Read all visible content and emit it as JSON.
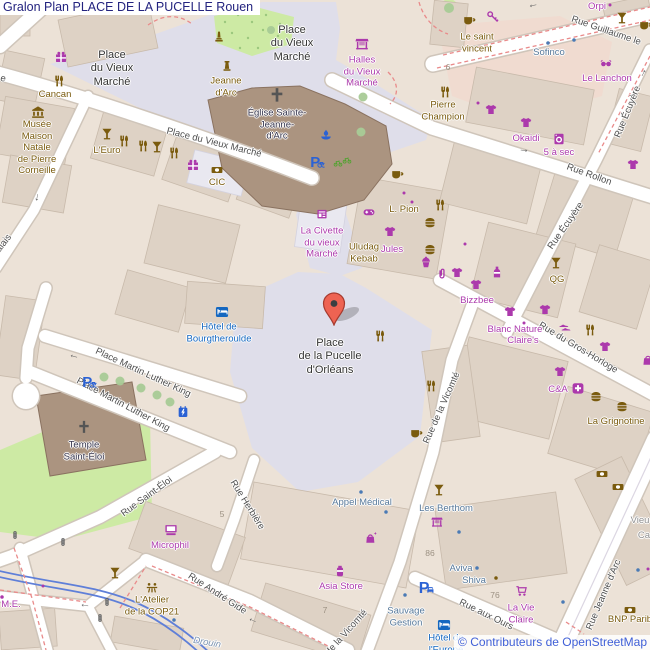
{
  "header": {
    "title": "Gralon Plan PLACE DE LA PUCELLE Rouen"
  },
  "attribution": {
    "text": "© Contributeurs de OpenStreetMap"
  },
  "palette": {
    "shop": "#ac39ac",
    "amenity": "#7a5b0e",
    "tourism": "#1467c0",
    "office": "#56789a",
    "church": "#38374f",
    "street": "#4e4e4e",
    "place": "#333333",
    "gray": "#909090",
    "water": "#7b93b0",
    "number": "#9c9183",
    "office_dot": "#4a7ab5",
    "transport": "#2b62d4",
    "green": "#4ba32a",
    "signal": "#555555",
    "marker": "#ee6352",
    "marker_border": "#a63a2e",
    "title": "#23237f",
    "attribution": "#3f5fd7",
    "pedestrian": "#dfdeea",
    "building": "#ded2c5",
    "land": "#ece2d7",
    "park": "#cdeaa4",
    "church_building": "#ab9480",
    "retail": "#f0dbd0",
    "dashed_path": "#e98a8a",
    "tram_line": "#5f7fd8",
    "road": "#ffffff",
    "road_casing": "#cfc5ba"
  },
  "marker": {
    "location": "Place de la Pucelle d'Orléans",
    "x": 334,
    "y": 325
  },
  "map": {
    "place_labels": [
      {
        "text": "Place\ndu Vieux\nMarché",
        "x": 112,
        "y": 69
      },
      {
        "text": "Place\ndu Vieux\nMarché",
        "x": 292,
        "y": 44
      },
      {
        "text": "Place\nde la Pucelle\nd'Orléans",
        "x": 330,
        "y": 357
      }
    ],
    "street_labels": [
      {
        "text": "Place du Vieux Marché",
        "x": 214,
        "y": 143,
        "rot": 14
      },
      {
        "text": "Place Martin Luther King",
        "x": 143,
        "y": 373,
        "rot": 25
      },
      {
        "text": "Place Martin Luther King",
        "x": 123,
        "y": 405,
        "rot": 28
      },
      {
        "text": "Rue Guillaume le",
        "x": 606,
        "y": 31,
        "rot": 19
      },
      {
        "text": "Rue Rollon",
        "x": 589,
        "y": 175,
        "rot": 20
      },
      {
        "text": "Rue Écuyère",
        "x": 628,
        "y": 112,
        "rot": -68
      },
      {
        "text": "Rue Écuyère",
        "x": 566,
        "y": 226,
        "rot": -55
      },
      {
        "text": "Rue du Gros-Horloge",
        "x": 578,
        "y": 348,
        "rot": 31
      },
      {
        "text": "Rue de la Vicomté",
        "x": 442,
        "y": 408,
        "rot": -66
      },
      {
        "text": "Rue de la Vicomté",
        "x": 340,
        "y": 640,
        "rot": -48
      },
      {
        "text": "Rue Jeanne d'Arc",
        "x": 604,
        "y": 595,
        "rot": -67
      },
      {
        "text": "Rue aux Ours",
        "x": 486,
        "y": 615,
        "rot": 26
      },
      {
        "text": "Rue Saint-Éloi",
        "x": 147,
        "y": 497,
        "rot": -36
      },
      {
        "text": "Rue Herbière",
        "x": 247,
        "y": 505,
        "rot": 58
      },
      {
        "text": "Rue André Gide",
        "x": 217,
        "y": 594,
        "rot": 33
      },
      {
        "text": "Palais",
        "x": 2,
        "y": 246,
        "rot": -52
      },
      {
        "text": "e",
        "x": 3,
        "y": 79,
        "rot": 15
      }
    ],
    "poi_labels": [
      {
        "text": "Halles\ndu Vieux\nMarché",
        "x": 362,
        "y": 72,
        "c": "shop"
      },
      {
        "text": "La Civette\ndu vieux\nMarché",
        "x": 322,
        "y": 243,
        "c": "shop"
      },
      {
        "text": "Jules",
        "x": 392,
        "y": 250,
        "c": "shop"
      },
      {
        "text": "Bizzbee",
        "x": 477,
        "y": 301,
        "c": "shop"
      },
      {
        "text": "Blanc Nature",
        "x": 515,
        "y": 330,
        "c": "shop"
      },
      {
        "text": "Claire's",
        "x": 523,
        "y": 341,
        "c": "shop"
      },
      {
        "text": "C&A",
        "x": 558,
        "y": 390,
        "c": "shop"
      },
      {
        "text": "Okaidi",
        "x": 526,
        "y": 139,
        "c": "shop"
      },
      {
        "text": "5 à sec",
        "x": 559,
        "y": 153,
        "c": "shop"
      },
      {
        "text": "Orpi",
        "x": 597,
        "y": 7,
        "c": "shop"
      },
      {
        "text": "Le Lanchon",
        "x": 607,
        "y": 79,
        "c": "shop"
      },
      {
        "text": "Microphil",
        "x": 170,
        "y": 546,
        "c": "shop"
      },
      {
        "text": "Asia Store",
        "x": 341,
        "y": 587,
        "c": "shop"
      },
      {
        "text": "La Vie\nClaire",
        "x": 521,
        "y": 614,
        "c": "shop"
      },
      {
        "text": "M.E.",
        "x": 11,
        "y": 605,
        "c": "shop"
      },
      {
        "text": "Cancan",
        "x": 55,
        "y": 95,
        "c": "amenity"
      },
      {
        "text": "Musée\nMaison\nNatale\nde Pierre\nCorneille",
        "x": 37,
        "y": 148,
        "c": "amenity"
      },
      {
        "text": "L'Euro",
        "x": 107,
        "y": 151,
        "c": "amenity"
      },
      {
        "text": "CIC",
        "x": 217,
        "y": 183,
        "c": "amenity"
      },
      {
        "text": "Jeanne\nd'Arc",
        "x": 226,
        "y": 87,
        "c": "amenity"
      },
      {
        "text": "Uludag\nKebab",
        "x": 364,
        "y": 253,
        "c": "amenity"
      },
      {
        "text": "L. Pion",
        "x": 404,
        "y": 210,
        "c": "amenity"
      },
      {
        "text": "QG",
        "x": 557,
        "y": 280,
        "c": "amenity"
      },
      {
        "text": "Le saint\nvincent",
        "x": 477,
        "y": 43,
        "c": "amenity"
      },
      {
        "text": "Pierre\nChampion",
        "x": 443,
        "y": 111,
        "c": "amenity"
      },
      {
        "text": "L'Atelier\nde la COP21",
        "x": 152,
        "y": 606,
        "c": "amenity"
      },
      {
        "text": "La Grignotine",
        "x": 616,
        "y": 422,
        "c": "amenity"
      },
      {
        "text": "BNP Parib",
        "x": 630,
        "y": 620,
        "c": "amenity"
      },
      {
        "text": "Hôtel de\nBourgtheroulde",
        "x": 219,
        "y": 333,
        "c": "tourism"
      },
      {
        "text": "Hôtel de\nl'Europe",
        "x": 446,
        "y": 644,
        "c": "tourism"
      },
      {
        "text": "Sofinco",
        "x": 549,
        "y": 53,
        "c": "office"
      },
      {
        "text": "Appel Médical",
        "x": 362,
        "y": 503,
        "c": "office"
      },
      {
        "text": "Les Berthom",
        "x": 446,
        "y": 509,
        "c": "office"
      },
      {
        "text": "Aviva",
        "x": 461,
        "y": 569,
        "c": "office"
      },
      {
        "text": "Shiva",
        "x": 474,
        "y": 581,
        "c": "office"
      },
      {
        "text": "Sauvage\nGestion",
        "x": 406,
        "y": 617,
        "c": "office"
      },
      {
        "text": "Église Sainte-\nJeanne-\nd'Arc",
        "x": 277,
        "y": 125,
        "c": "church"
      },
      {
        "text": "Temple\nSaint-Éloi",
        "x": 84,
        "y": 451,
        "c": "church"
      },
      {
        "text": "Vieu",
        "x": 640,
        "y": 521,
        "c": "gray"
      },
      {
        "text": "Ca",
        "x": 644,
        "y": 536,
        "c": "gray"
      },
      {
        "text": "Drouin",
        "x": 207,
        "y": 643,
        "c": "water",
        "rot": 10
      }
    ],
    "house_numbers": [
      {
        "text": "6",
        "x": 448,
        "y": 67
      },
      {
        "text": "5",
        "x": 222,
        "y": 514
      },
      {
        "text": "86",
        "x": 430,
        "y": 553
      },
      {
        "text": "76",
        "x": 495,
        "y": 595
      },
      {
        "text": "7",
        "x": 325,
        "y": 610
      }
    ],
    "arrows": [
      {
        "g": "←",
        "x": 74,
        "y": 356,
        "rot": 15
      },
      {
        "g": "↓",
        "x": 37,
        "y": 198,
        "rot": 10
      },
      {
        "g": "←",
        "x": 533,
        "y": 5,
        "rot": -12
      },
      {
        "g": "→",
        "x": 643,
        "y": 73,
        "rot": -62
      },
      {
        "g": "→",
        "x": 524,
        "y": 150,
        "rot": 8
      },
      {
        "g": "←",
        "x": 253,
        "y": 620,
        "rot": 25
      },
      {
        "g": "←",
        "x": 85,
        "y": 605,
        "rot": 8
      }
    ],
    "icons": [
      {
        "t": "fork",
        "x": 59,
        "y": 81,
        "c": "amenity"
      },
      {
        "t": "museum",
        "x": 38,
        "y": 112,
        "c": "amenity",
        "s": 14
      },
      {
        "t": "cocktail",
        "x": 107,
        "y": 134,
        "c": "amenity"
      },
      {
        "t": "fork",
        "x": 124,
        "y": 141,
        "c": "amenity"
      },
      {
        "t": "fork",
        "x": 143,
        "y": 146,
        "c": "amenity"
      },
      {
        "t": "cocktail",
        "x": 157,
        "y": 147,
        "c": "amenity"
      },
      {
        "t": "fork",
        "x": 174,
        "y": 153,
        "c": "amenity"
      },
      {
        "t": "bank",
        "x": 217,
        "y": 170,
        "c": "amenity"
      },
      {
        "t": "coffee",
        "x": 397,
        "y": 174,
        "c": "amenity"
      },
      {
        "t": "fork",
        "x": 440,
        "y": 205,
        "c": "amenity"
      },
      {
        "t": "burger",
        "x": 430,
        "y": 223,
        "c": "amenity"
      },
      {
        "t": "burger",
        "x": 430,
        "y": 250,
        "c": "amenity"
      },
      {
        "t": "cocktail",
        "x": 556,
        "y": 263,
        "c": "amenity"
      },
      {
        "t": "coffee",
        "x": 469,
        "y": 20,
        "c": "amenity"
      },
      {
        "t": "cocktail",
        "x": 622,
        "y": 18,
        "c": "amenity"
      },
      {
        "t": "coffee",
        "x": 645,
        "y": 25,
        "c": "amenity"
      },
      {
        "t": "fork",
        "x": 445,
        "y": 92,
        "c": "amenity"
      },
      {
        "t": "fork",
        "x": 380,
        "y": 336,
        "c": "amenity"
      },
      {
        "t": "fork",
        "x": 431,
        "y": 386,
        "c": "amenity"
      },
      {
        "t": "coffee",
        "x": 416,
        "y": 433,
        "c": "amenity"
      },
      {
        "t": "cocktail",
        "x": 439,
        "y": 490,
        "c": "amenity"
      },
      {
        "t": "cocktail",
        "x": 115,
        "y": 573,
        "c": "amenity"
      },
      {
        "t": "picnic",
        "x": 152,
        "y": 588,
        "c": "amenity"
      },
      {
        "t": "monument",
        "x": 219,
        "y": 37,
        "c": "amenity"
      },
      {
        "t": "statue",
        "x": 227,
        "y": 66,
        "c": "amenity"
      },
      {
        "t": "burger",
        "x": 596,
        "y": 397,
        "c": "amenity"
      },
      {
        "t": "burger",
        "x": 622,
        "y": 407,
        "c": "amenity"
      },
      {
        "t": "fork",
        "x": 590,
        "y": 330,
        "c": "amenity"
      },
      {
        "t": "bank",
        "x": 602,
        "y": 474,
        "c": "amenity"
      },
      {
        "t": "bank",
        "x": 618,
        "y": 487,
        "c": "amenity"
      },
      {
        "t": "bank",
        "x": 630,
        "y": 610,
        "c": "amenity"
      },
      {
        "t": "dot",
        "x": 496,
        "y": 578,
        "c": "amenity",
        "s": 7
      },
      {
        "t": "gift",
        "x": 61,
        "y": 57,
        "c": "shop"
      },
      {
        "t": "gift",
        "x": 193,
        "y": 165,
        "c": "shop"
      },
      {
        "t": "kiosk",
        "x": 322,
        "y": 214,
        "c": "shop"
      },
      {
        "t": "gamepad",
        "x": 369,
        "y": 212,
        "c": "shop"
      },
      {
        "t": "tshirt",
        "x": 390,
        "y": 232,
        "c": "shop"
      },
      {
        "t": "cupcake",
        "x": 426,
        "y": 262,
        "c": "shop"
      },
      {
        "t": "paperclip",
        "x": 442,
        "y": 274,
        "c": "shop"
      },
      {
        "t": "tshirt",
        "x": 457,
        "y": 273,
        "c": "shop"
      },
      {
        "t": "bottle",
        "x": 497,
        "y": 272,
        "c": "shop"
      },
      {
        "t": "tshirt",
        "x": 476,
        "y": 285,
        "c": "shop"
      },
      {
        "t": "tshirt",
        "x": 510,
        "y": 312,
        "c": "shop"
      },
      {
        "t": "tshirt",
        "x": 545,
        "y": 310,
        "c": "shop"
      },
      {
        "t": "dot",
        "x": 524,
        "y": 323,
        "c": "shop",
        "s": 6
      },
      {
        "t": "tshirt",
        "x": 605,
        "y": 347,
        "c": "shop"
      },
      {
        "t": "tshirt",
        "x": 560,
        "y": 372,
        "c": "shop"
      },
      {
        "t": "chemist",
        "x": 578,
        "y": 388,
        "c": "shop"
      },
      {
        "t": "shoes",
        "x": 565,
        "y": 327,
        "c": "shop"
      },
      {
        "t": "stall",
        "x": 362,
        "y": 44,
        "c": "shop",
        "s": 14
      },
      {
        "t": "sunglasses",
        "x": 606,
        "y": 64,
        "c": "shop"
      },
      {
        "t": "key",
        "x": 493,
        "y": 17,
        "c": "shop"
      },
      {
        "t": "tshirt",
        "x": 491,
        "y": 110,
        "c": "shop"
      },
      {
        "t": "tshirt",
        "x": 526,
        "y": 123,
        "c": "shop"
      },
      {
        "t": "dot",
        "x": 478,
        "y": 103,
        "c": "shop",
        "s": 6
      },
      {
        "t": "washing",
        "x": 559,
        "y": 139,
        "c": "shop"
      },
      {
        "t": "tshirt",
        "x": 633,
        "y": 165,
        "c": "shop"
      },
      {
        "t": "dot",
        "x": 610,
        "y": 5,
        "c": "shop",
        "s": 6
      },
      {
        "t": "dot",
        "x": 404,
        "y": 193,
        "c": "shop",
        "s": 6
      },
      {
        "t": "dot",
        "x": 412,
        "y": 202,
        "c": "shop",
        "s": 6
      },
      {
        "t": "computer",
        "x": 171,
        "y": 530,
        "c": "shop",
        "s": 14
      },
      {
        "t": "dot",
        "x": 43,
        "y": 586,
        "c": "shop",
        "s": 6
      },
      {
        "t": "bagspark",
        "x": 371,
        "y": 538,
        "c": "shop"
      },
      {
        "t": "jar",
        "x": 340,
        "y": 571,
        "c": "shop"
      },
      {
        "t": "cart",
        "x": 522,
        "y": 591,
        "c": "shop"
      },
      {
        "t": "stall",
        "x": 437,
        "y": 522,
        "c": "shop",
        "s": 12
      },
      {
        "t": "dot",
        "x": 465,
        "y": 244,
        "c": "shop",
        "s": 6
      },
      {
        "t": "bag",
        "x": 648,
        "y": 360,
        "c": "shop"
      },
      {
        "t": "dot",
        "x": 648,
        "y": 569,
        "c": "shop",
        "s": 6
      },
      {
        "t": "dot",
        "x": 2,
        "y": 597,
        "c": "shop",
        "s": 7
      },
      {
        "t": "bed",
        "x": 222,
        "y": 312,
        "c": "tourism",
        "s": 13
      },
      {
        "t": "bed",
        "x": 444,
        "y": 625,
        "c": "tourism",
        "s": 13
      },
      {
        "t": "fountain",
        "x": 326,
        "y": 135,
        "c": "transport"
      },
      {
        "t": "parking",
        "x": 317,
        "y": 161,
        "c": "transport",
        "s": 15
      },
      {
        "t": "parking",
        "x": 89,
        "y": 381,
        "c": "transport",
        "s": 15
      },
      {
        "t": "ev",
        "x": 183,
        "y": 412,
        "c": "transport"
      },
      {
        "t": "parkingcar",
        "x": 426,
        "y": 587,
        "c": "transport",
        "s": 16
      },
      {
        "t": "cross",
        "x": 277,
        "y": 95,
        "c": "signal",
        "s": 16
      },
      {
        "t": "cross",
        "x": 84,
        "y": 427,
        "c": "signal",
        "s": 14
      },
      {
        "t": "dot",
        "x": 548,
        "y": 43,
        "c": "office_dot",
        "s": 7
      },
      {
        "t": "dot",
        "x": 574,
        "y": 40,
        "c": "office_dot",
        "s": 7
      },
      {
        "t": "dot",
        "x": 361,
        "y": 492,
        "c": "office_dot",
        "s": 7
      },
      {
        "t": "dot",
        "x": 386,
        "y": 512,
        "c": "office_dot",
        "s": 7
      },
      {
        "t": "dot",
        "x": 405,
        "y": 595,
        "c": "office_dot",
        "s": 7
      },
      {
        "t": "dot",
        "x": 459,
        "y": 532,
        "c": "office_dot",
        "s": 7
      },
      {
        "t": "dot",
        "x": 563,
        "y": 602,
        "c": "office_dot",
        "s": 7
      },
      {
        "t": "dot",
        "x": 638,
        "y": 570,
        "c": "office_dot",
        "s": 7
      },
      {
        "t": "dot",
        "x": 477,
        "y": 568,
        "c": "office_dot",
        "s": 7
      },
      {
        "t": "dot",
        "x": 174,
        "y": 620,
        "c": "office_dot",
        "s": 7
      },
      {
        "t": "bike",
        "x": 338,
        "y": 163,
        "c": "green",
        "s": 9
      },
      {
        "t": "bike",
        "x": 347,
        "y": 160,
        "c": "green",
        "s": 9
      },
      {
        "t": "signal",
        "x": 15,
        "y": 535,
        "c": "signal",
        "s": 8
      },
      {
        "t": "signal",
        "x": 63,
        "y": 542,
        "c": "signal",
        "s": 8
      },
      {
        "t": "signal",
        "x": 107,
        "y": 602,
        "c": "signal",
        "s": 8
      },
      {
        "t": "signal",
        "x": 100,
        "y": 618,
        "c": "signal",
        "s": 8
      }
    ]
  }
}
